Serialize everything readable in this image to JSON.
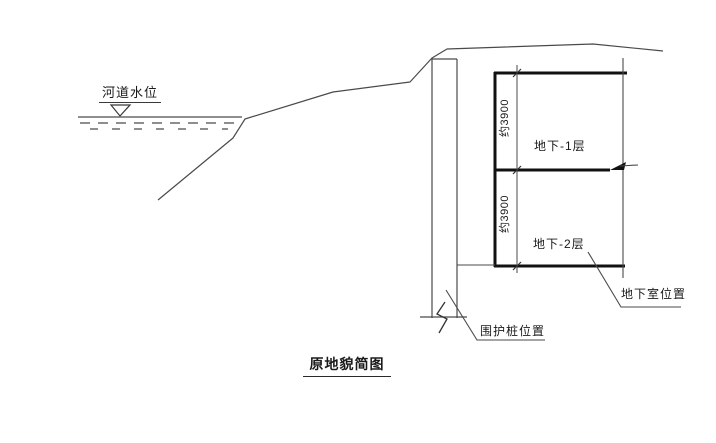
{
  "diagram": {
    "title": "原地貌简图",
    "river": {
      "water_level_label": "河道水位"
    },
    "basement": {
      "level1": {
        "dim": "约3900",
        "label": "地下-1层"
      },
      "level2": {
        "dim": "约3900",
        "label": "地下-2层"
      },
      "position_label": "地下室位置"
    },
    "pile": {
      "position_label": "围护桩位置"
    },
    "colors": {
      "thin_line": "#4a4a4a",
      "slab_line": "#111111",
      "water_line": "#6a6a6a",
      "text": "#1a1a1a",
      "background": "#ffffff"
    }
  }
}
